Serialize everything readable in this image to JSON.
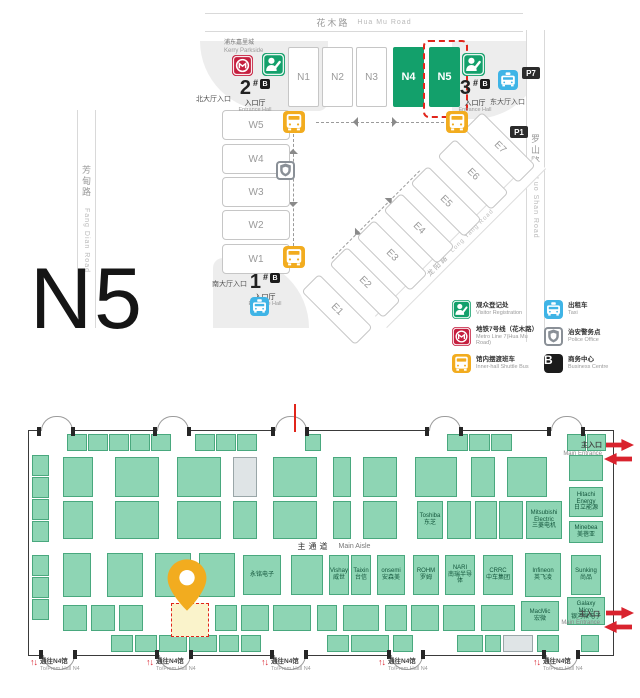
{
  "colors": {
    "green": "#13a06b",
    "metro_red": "#c51f3f",
    "shuttle_yellow": "#f2ac1f",
    "taxi_blue": "#3fb4e6",
    "police_gray": "#8a9097",
    "black": "#1b1b1b",
    "booth_fill": "#8ed5b4",
    "booth_border": "#49a87e",
    "highlight_red": "#e1251b",
    "pin_yellow": "#f2ac1f"
  },
  "overview": {
    "big_label": "N5",
    "roads": {
      "top": {
        "zh": "花木路",
        "en": "Hua Mu Road"
      },
      "right": {
        "zh": "罗山路",
        "en": "Luo Shan Road"
      },
      "left": {
        "zh": "芳甸路",
        "en": "Fang Dian Road"
      },
      "diagonal": {
        "zh": "龙阳路",
        "en": "Long Yang Road"
      }
    },
    "landmark": {
      "zh": "浦东嘉里城",
      "en": "Kerry Parkside"
    },
    "halls_north": [
      {
        "label": "N1",
        "x": 288,
        "green": false
      },
      {
        "label": "N2",
        "x": 322,
        "green": false
      },
      {
        "label": "N3",
        "x": 356,
        "green": false
      },
      {
        "label": "N4",
        "x": 393,
        "green": true
      },
      {
        "label": "N5",
        "x": 429,
        "green": true
      }
    ],
    "selected_hall": "N5",
    "halls_west": [
      {
        "label": "W5",
        "y": 110
      },
      {
        "label": "W4",
        "y": 144
      },
      {
        "label": "W3",
        "y": 177
      },
      {
        "label": "W2",
        "y": 210
      },
      {
        "label": "W1",
        "y": 244
      }
    ],
    "halls_east": [
      {
        "label": "E1",
        "x": 299,
        "y": 297
      },
      {
        "label": "E2",
        "x": 327,
        "y": 270
      },
      {
        "label": "E3",
        "x": 354,
        "y": 243
      },
      {
        "label": "E4",
        "x": 381,
        "y": 216
      },
      {
        "label": "E5",
        "x": 408,
        "y": 189
      },
      {
        "label": "E6",
        "x": 435,
        "y": 162
      },
      {
        "label": "E7",
        "x": 462,
        "y": 135
      }
    ],
    "entrances": [
      {
        "num": "1",
        "hash": "#",
        "badge": "B",
        "zh": "入口厅",
        "en": "Entrance Hall",
        "side": "南大厅入口"
      },
      {
        "num": "2",
        "hash": "#",
        "badge": "B",
        "zh": "入口厅",
        "en": "Entrance Hall",
        "side": "北大厅入口"
      },
      {
        "num": "3",
        "hash": "#",
        "badge": "B",
        "zh": "入口厅",
        "en": "Entrance Hall",
        "side": "东大厅入口"
      }
    ],
    "parking": [
      {
        "label": "P7",
        "x": 522,
        "y": 67
      },
      {
        "label": "P1",
        "x": 510,
        "y": 126
      }
    ],
    "map_icons": [
      {
        "icon": "metro",
        "x": 232,
        "y": 55,
        "s": 21
      },
      {
        "icon": "registration",
        "x": 262,
        "y": 53,
        "s": 23
      },
      {
        "icon": "registration",
        "x": 462,
        "y": 53,
        "s": 23
      },
      {
        "icon": "taxi",
        "x": 498,
        "y": 70,
        "s": 20
      },
      {
        "icon": "taxi",
        "x": 250,
        "y": 297,
        "s": 19
      },
      {
        "icon": "shuttle",
        "x": 283,
        "y": 111,
        "s": 22
      },
      {
        "icon": "shuttle",
        "x": 446,
        "y": 111,
        "s": 22
      },
      {
        "icon": "shuttle",
        "x": 283,
        "y": 246,
        "s": 22
      },
      {
        "icon": "police",
        "x": 276,
        "y": 161,
        "s": 19
      }
    ],
    "legend": [
      {
        "icon": "registration",
        "zh": "观众登记处",
        "en": "Visitor Registration"
      },
      {
        "icon": "taxi",
        "zh": "出租车",
        "en": "Taxi"
      },
      {
        "icon": "metro",
        "zh": "地铁7号线（花木路）",
        "en": "Metro Line 7(Hua Mu Road)"
      },
      {
        "icon": "police",
        "zh": "治安警务点",
        "en": "Police Office"
      },
      {
        "icon": "shuttle",
        "zh": "馆内摆渡班车",
        "en": "Inner-hall Shuttle Bus"
      },
      {
        "icon": "business",
        "zh": "商务中心",
        "en": "Business Centre"
      }
    ]
  },
  "hallmap": {
    "aisle": {
      "zh": "主通道",
      "en": "Main Aisle"
    },
    "main_entrance": {
      "zh": "主入口",
      "en": "Main Entrance"
    },
    "gate": {
      "zh": "通往N4馆",
      "en": "To/From Hall N4",
      "up": "↑",
      "down": "↓"
    },
    "gate_xs": [
      57,
      173,
      288,
      405,
      560
    ],
    "doors_top": [
      12,
      128,
      246,
      400,
      522
    ],
    "doors_bottom": [
      14,
      130,
      245,
      362,
      517
    ],
    "booths": [
      [
        38,
        3,
        20,
        17,
        ""
      ],
      [
        59,
        3,
        20,
        17,
        ""
      ],
      [
        80,
        3,
        20,
        17,
        ""
      ],
      [
        101,
        3,
        20,
        17,
        ""
      ],
      [
        122,
        3,
        20,
        17,
        ""
      ],
      [
        166,
        3,
        20,
        17,
        ""
      ],
      [
        187,
        3,
        20,
        17,
        ""
      ],
      [
        208,
        3,
        20,
        17,
        ""
      ],
      [
        276,
        3,
        16,
        17,
        ""
      ],
      [
        418,
        3,
        21,
        17,
        ""
      ],
      [
        440,
        3,
        21,
        17,
        ""
      ],
      [
        462,
        3,
        21,
        17,
        ""
      ],
      [
        538,
        3,
        19,
        17,
        ""
      ],
      [
        558,
        3,
        19,
        17,
        ""
      ],
      [
        3,
        24,
        17,
        21,
        ""
      ],
      [
        3,
        46,
        17,
        21,
        ""
      ],
      [
        3,
        68,
        17,
        21,
        ""
      ],
      [
        3,
        90,
        17,
        21,
        ""
      ],
      [
        3,
        124,
        17,
        21,
        ""
      ],
      [
        3,
        146,
        17,
        21,
        ""
      ],
      [
        3,
        168,
        17,
        21,
        ""
      ],
      [
        34,
        26,
        30,
        40,
        ""
      ],
      [
        86,
        26,
        44,
        40,
        ""
      ],
      [
        148,
        26,
        44,
        40,
        ""
      ],
      [
        204,
        26,
        24,
        40,
        "",
        1
      ],
      [
        244,
        26,
        44,
        40,
        ""
      ],
      [
        304,
        26,
        18,
        40,
        ""
      ],
      [
        334,
        26,
        34,
        40,
        ""
      ],
      [
        386,
        26,
        42,
        40,
        ""
      ],
      [
        442,
        26,
        24,
        40,
        ""
      ],
      [
        478,
        26,
        40,
        40,
        ""
      ],
      [
        540,
        24,
        34,
        26,
        ""
      ],
      [
        540,
        56,
        34,
        30,
        "Hitachi Energy\n日立能源"
      ],
      [
        540,
        90,
        34,
        22,
        "Minebea\n美蓓亚"
      ],
      [
        34,
        70,
        30,
        38,
        ""
      ],
      [
        86,
        70,
        44,
        38,
        ""
      ],
      [
        148,
        70,
        44,
        38,
        ""
      ],
      [
        204,
        70,
        24,
        38,
        ""
      ],
      [
        244,
        70,
        44,
        38,
        ""
      ],
      [
        304,
        70,
        18,
        38,
        ""
      ],
      [
        334,
        70,
        34,
        38,
        ""
      ],
      [
        388,
        70,
        26,
        38,
        "Toshiba\n东芝"
      ],
      [
        418,
        70,
        24,
        38,
        ""
      ],
      [
        446,
        70,
        22,
        38,
        ""
      ],
      [
        470,
        70,
        24,
        38,
        ""
      ],
      [
        497,
        70,
        36,
        38,
        "Mitsubishi Electric\n三菱电机"
      ],
      [
        34,
        122,
        28,
        44,
        ""
      ],
      [
        78,
        122,
        36,
        44,
        ""
      ],
      [
        126,
        122,
        36,
        44,
        ""
      ],
      [
        170,
        122,
        36,
        44,
        ""
      ],
      [
        214,
        124,
        38,
        40,
        "永铭电子"
      ],
      [
        262,
        124,
        32,
        40,
        ""
      ],
      [
        300,
        124,
        20,
        40,
        "Vishay\n威世"
      ],
      [
        322,
        124,
        20,
        40,
        "Taixin\n台信"
      ],
      [
        348,
        124,
        28,
        40,
        "onsemi\n安森美"
      ],
      [
        384,
        124,
        26,
        40,
        "ROHM\n罗姆"
      ],
      [
        416,
        124,
        30,
        40,
        "NARI\n南瑞半导体"
      ],
      [
        454,
        124,
        30,
        40,
        "CRRC\n中车集团"
      ],
      [
        496,
        122,
        36,
        44,
        "Infineon\n英飞凌"
      ],
      [
        542,
        124,
        30,
        40,
        "Sunking\n尚品"
      ],
      [
        34,
        174,
        24,
        26,
        ""
      ],
      [
        62,
        174,
        24,
        26,
        ""
      ],
      [
        90,
        174,
        24,
        26,
        ""
      ],
      [
        142,
        172,
        38,
        34,
        "",
        2
      ],
      [
        186,
        174,
        22,
        26,
        ""
      ],
      [
        212,
        174,
        28,
        26,
        ""
      ],
      [
        244,
        174,
        38,
        26,
        ""
      ],
      [
        288,
        174,
        20,
        26,
        ""
      ],
      [
        314,
        174,
        36,
        26,
        ""
      ],
      [
        356,
        174,
        22,
        26,
        ""
      ],
      [
        382,
        174,
        28,
        26,
        ""
      ],
      [
        414,
        174,
        32,
        26,
        ""
      ],
      [
        452,
        174,
        34,
        26,
        ""
      ],
      [
        492,
        170,
        38,
        30,
        "MacMic\n宏微"
      ],
      [
        538,
        166,
        38,
        28,
        "Galaxy Micro\n银河微电子"
      ],
      [
        82,
        204,
        22,
        17,
        ""
      ],
      [
        106,
        204,
        22,
        17,
        ""
      ],
      [
        130,
        204,
        28,
        17,
        ""
      ],
      [
        160,
        204,
        28,
        17,
        ""
      ],
      [
        190,
        204,
        20,
        17,
        ""
      ],
      [
        212,
        204,
        20,
        17,
        ""
      ],
      [
        298,
        204,
        22,
        17,
        ""
      ],
      [
        322,
        204,
        38,
        17,
        ""
      ],
      [
        364,
        204,
        20,
        17,
        ""
      ],
      [
        428,
        204,
        26,
        17,
        ""
      ],
      [
        456,
        204,
        16,
        17,
        ""
      ],
      [
        474,
        204,
        30,
        17,
        "",
        1
      ],
      [
        508,
        204,
        22,
        17,
        ""
      ],
      [
        552,
        204,
        18,
        17,
        ""
      ]
    ]
  }
}
